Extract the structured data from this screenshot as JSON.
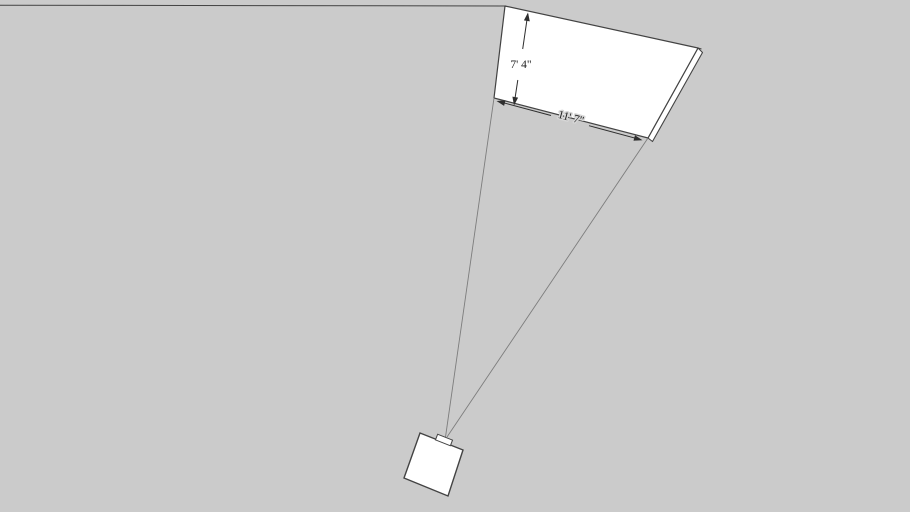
{
  "canvas": {
    "width": "910",
    "height": "512",
    "background_color": "#cbcbcb"
  },
  "colors": {
    "face_fill": "#ffffff",
    "edge_stroke": "#434343",
    "guide_stroke": "#7d7d7d",
    "dimension_stroke": "#2e2e2e",
    "dimension_text": "#1c1c1c"
  },
  "model": {
    "screen": {
      "height_dimension_label": "7' 4\"",
      "width_dimension_label": "11' 7\""
    }
  }
}
